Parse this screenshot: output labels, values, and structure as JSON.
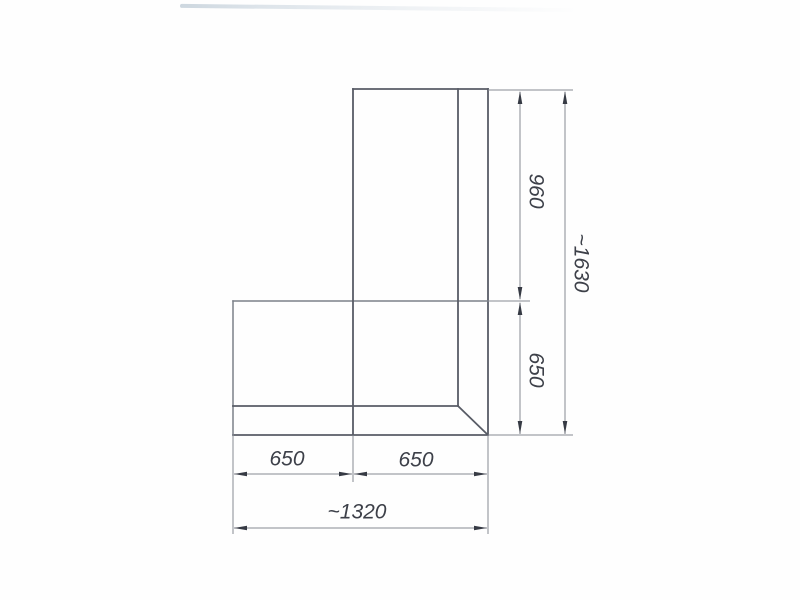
{
  "drawing": {
    "kind": "technical-dimension-drawing",
    "subject": "L-shaped corner unit, plan view with mitred corner",
    "dimensions": {
      "right_upper": "960",
      "right_lower": "650",
      "right_overall": "~1630",
      "bottom_left": "650",
      "bottom_right": "650",
      "bottom_overall": "~1320"
    },
    "colors": {
      "background": "#fefefe",
      "outline": "#585c66",
      "dimension_lines": "#868a93",
      "arrowheads": "#363a44",
      "text": "#3d4049",
      "scan_artifact": "#cdd7df"
    }
  }
}
